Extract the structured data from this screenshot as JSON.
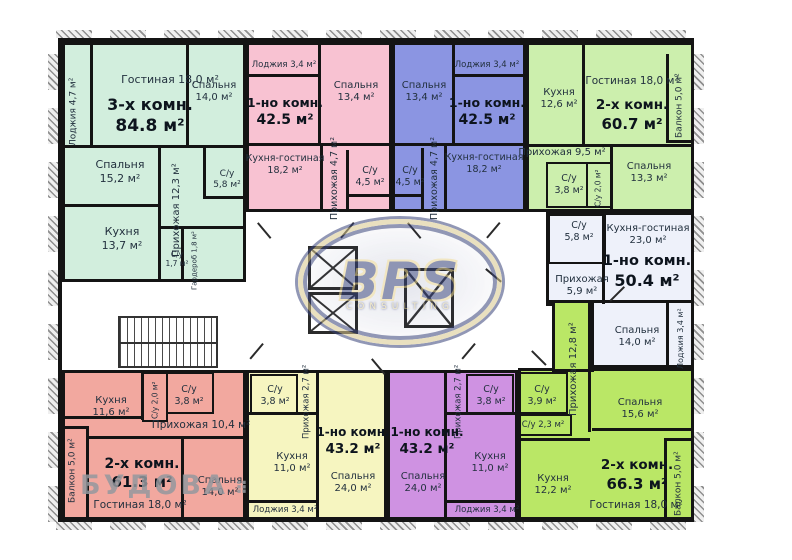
{
  "watermarks": {
    "bps": {
      "text": "BPS",
      "subtext": "consulting"
    },
    "budova": {
      "text": "БУДОВА",
      "icon": "⠿"
    }
  },
  "plan": {
    "wall_color": "#141414",
    "apartments": [
      {
        "id": "a1",
        "color": "#d2eedd",
        "title": {
          "type": "3-х комн.",
          "area": "84.8 м²"
        },
        "rooms": [
          {
            "id": "a1-loggia",
            "text": "Лоджия 4,7 м²",
            "vertical": true
          },
          {
            "id": "a1-living",
            "lines": [
              "Гостиная 18,0 м²"
            ]
          },
          {
            "id": "a1-bed1",
            "lines": [
              "Спальня",
              "14,0 м²"
            ]
          },
          {
            "id": "a1-bed2",
            "lines": [
              "Спальня",
              "15,2 м²"
            ]
          },
          {
            "id": "a1-hall",
            "text": "Прихожая 12,3 м²",
            "vertical": true
          },
          {
            "id": "a1-kitchen",
            "lines": [
              "Кухня",
              "13,7 м²"
            ]
          },
          {
            "id": "a1-wc1",
            "lines": [
              "С/у",
              "5,8 м²"
            ]
          },
          {
            "id": "a1-wc2",
            "lines": [
              "С/у",
              "1,7 м²"
            ]
          },
          {
            "id": "a1-ward",
            "text": "Гардероб 1,8 м²",
            "vertical": true
          }
        ]
      },
      {
        "id": "a2",
        "color": "#f8c2d2",
        "title": {
          "type": "1-но комн.",
          "area": "42.5 м²"
        },
        "rooms": [
          {
            "id": "a2-loggia",
            "lines": [
              "Лоджия 3,4 м²"
            ]
          },
          {
            "id": "a2-bed",
            "lines": [
              "Спальня",
              "13,4 м²"
            ]
          },
          {
            "id": "a2-kitchen",
            "lines": [
              "Кухня-гостиная",
              "18,2 м²"
            ]
          },
          {
            "id": "a2-hall",
            "text": "Прихожая 4,7 м²",
            "vertical": true
          },
          {
            "id": "a2-wc",
            "lines": [
              "С/у",
              "4,5 м²"
            ]
          }
        ]
      },
      {
        "id": "a3",
        "color": "#8b95e2",
        "title": {
          "type": "1-но комн.",
          "area": "42.5 м²"
        },
        "rooms": [
          {
            "id": "a3-bed",
            "lines": [
              "Спальня",
              "13,4 м²"
            ]
          },
          {
            "id": "a3-loggia",
            "lines": [
              "Лоджия 3,4 м²"
            ]
          },
          {
            "id": "a3-wc",
            "lines": [
              "С/у",
              "4,5 м²"
            ]
          },
          {
            "id": "a3-hall",
            "text": "Прихожая 4,7 м²",
            "vertical": true
          },
          {
            "id": "a3-kitchen",
            "lines": [
              "Кухня-гостиная",
              "18,2 м²"
            ]
          }
        ]
      },
      {
        "id": "a4",
        "color": "#ccefad",
        "title": {
          "type": "2-х комн.",
          "area": "60.7 м²"
        },
        "rooms": [
          {
            "id": "a4-kitchen",
            "lines": [
              "Кухня",
              "12,6 м²"
            ]
          },
          {
            "id": "a4-living",
            "lines": [
              "Гостиная 18,0 м²"
            ]
          },
          {
            "id": "a4-balcony",
            "text": "Балкон 5,0 м²",
            "vertical": true
          },
          {
            "id": "a4-hall",
            "lines": [
              "Прихожая 9,5 м²"
            ]
          },
          {
            "id": "a4-wc1",
            "lines": [
              "С/у",
              "3,8 м²"
            ]
          },
          {
            "id": "a4-wc2",
            "text": "С/у 2,0 м²",
            "vertical": true
          },
          {
            "id": "a4-bed",
            "lines": [
              "Спальня",
              "13,3 м²"
            ]
          }
        ]
      },
      {
        "id": "a5",
        "color": "#eef1fa",
        "title": {
          "type": "1-но комн.",
          "area": "50.4 м²"
        },
        "rooms": [
          {
            "id": "a5-wc",
            "lines": [
              "С/у",
              "5,8 м²"
            ]
          },
          {
            "id": "a5-kitchen",
            "lines": [
              "Кухня-гостиная",
              "23,0 м²"
            ]
          },
          {
            "id": "a5-hall",
            "lines": [
              "Прихожая",
              "5,9 м²"
            ]
          },
          {
            "id": "a5-bed",
            "lines": [
              "Спальня",
              "14,0 м²"
            ]
          },
          {
            "id": "a5-loggia",
            "text": "Лоджия 3,4 м²",
            "vertical": true
          }
        ]
      },
      {
        "id": "a6",
        "color": "#f2a89f",
        "title": {
          "type": "2-х комн.",
          "area": "61.3 м²"
        },
        "rooms": [
          {
            "id": "a6-kitchen",
            "lines": [
              "Кухня",
              "11,6 м²"
            ]
          },
          {
            "id": "a6-wc1",
            "text": "С/у 2,0 м²",
            "vertical": true
          },
          {
            "id": "a6-wc2",
            "lines": [
              "С/у",
              "3,8 м²"
            ]
          },
          {
            "id": "a6-hall",
            "lines": [
              "Прихожая 10,4 м²"
            ]
          },
          {
            "id": "a6-balcony",
            "text": "Балкон 5,0 м²",
            "vertical": true
          },
          {
            "id": "a6-living",
            "lines": [
              "Гостиная 18,0 м²"
            ]
          },
          {
            "id": "a6-bed",
            "lines": [
              "Спальня",
              "14,0 м²"
            ]
          }
        ]
      },
      {
        "id": "a7",
        "color": "#f6f5c0",
        "title": {
          "type": "1-но комн.",
          "area": "43.2 м²"
        },
        "rooms": [
          {
            "id": "a7-wc",
            "lines": [
              "С/у",
              "3,8 м²"
            ]
          },
          {
            "id": "a7-hall",
            "text": "Прихожая 2,7 м²",
            "vertical": true
          },
          {
            "id": "a7-kitchen",
            "lines": [
              "Кухня",
              "11,0 м²"
            ]
          },
          {
            "id": "a7-bed",
            "lines": [
              "Спальня",
              "24,0 м²"
            ]
          },
          {
            "id": "a7-loggia",
            "lines": [
              "Лоджия 3,4 м²"
            ]
          }
        ]
      },
      {
        "id": "a8",
        "color": "#cf92e2",
        "title": {
          "type": "1-но комн.",
          "area": "43.2 м²"
        },
        "rooms": [
          {
            "id": "a8-hall",
            "text": "Прихожая 2,7 м²",
            "vertical": true
          },
          {
            "id": "a8-wc",
            "lines": [
              "С/у",
              "3,8 м²"
            ]
          },
          {
            "id": "a8-kitchen",
            "lines": [
              "Кухня",
              "11,0 м²"
            ]
          },
          {
            "id": "a8-bed",
            "lines": [
              "Спальня",
              "24,0 м²"
            ]
          },
          {
            "id": "a8-loggia",
            "lines": [
              "Лоджия 3,4 м²"
            ]
          }
        ]
      },
      {
        "id": "a9",
        "color": "#bae766",
        "title": {
          "type": "2-х комн.",
          "area": "66.3 м²"
        },
        "rooms": [
          {
            "id": "a9-wc1",
            "lines": [
              "С/у",
              "3,9 м²"
            ]
          },
          {
            "id": "a9-wc2",
            "lines": [
              "С/у 2,3 м²"
            ]
          },
          {
            "id": "a9-hall",
            "text": "Прихожая 12,8 м²",
            "vertical": true
          },
          {
            "id": "a9-kitchen",
            "lines": [
              "Кухня",
              "12,2 м²"
            ]
          },
          {
            "id": "a9-bed",
            "lines": [
              "Спальня",
              "15,6 м²"
            ]
          },
          {
            "id": "a9-living",
            "lines": [
              "Гостиная 18,0 м²"
            ]
          },
          {
            "id": "a9-balcony",
            "text": "Балкон 5,0 м²",
            "vertical": true
          }
        ]
      }
    ]
  }
}
